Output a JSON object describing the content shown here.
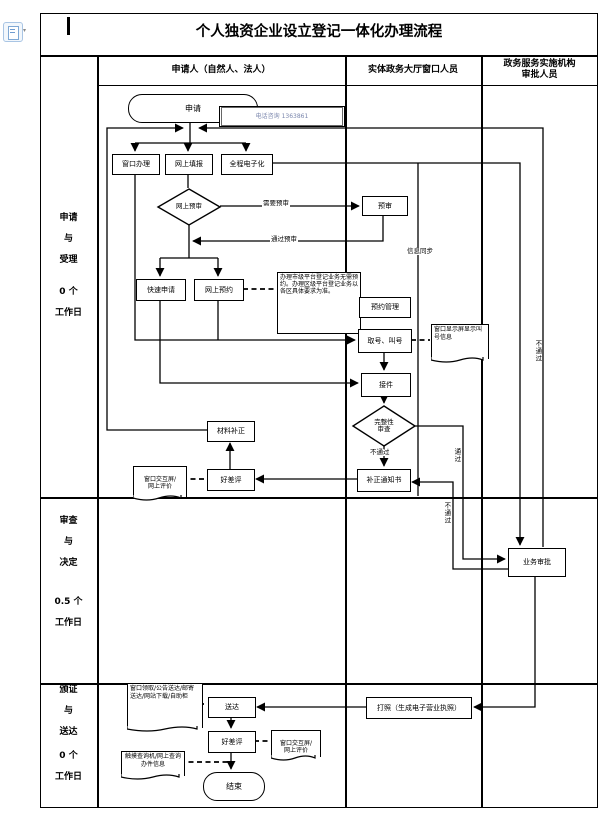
{
  "title": "个人独资企业设立登记一体化办理流程",
  "icons": {
    "top_left": "paste-options-icon",
    "top_left_caret": "dropdown-caret",
    "cursor_mark": "text-cursor-bar"
  },
  "header": {
    "col_applicant": "申请人（自然人、法人）",
    "col_window": "实体政务大厅窗口人员",
    "col_agency": "政务服务实施机构\n审批人员"
  },
  "stages": {
    "apply": {
      "name": "申请\n与\n受理",
      "duration": "0 个\n工作日"
    },
    "review": {
      "name": "审查\n与\n决定",
      "duration": "0.5 个\n工作日"
    },
    "issue": {
      "name": "颁证\n与\n送达",
      "duration": "0 个\n工作日"
    }
  },
  "nodes": {
    "start": "申请",
    "phone_note": "电话咨询 1363861",
    "window_handle": "窗口办理",
    "online_fill": "网上填报",
    "full_electronic": "全程电子化",
    "online_precheck": "网上预审",
    "precheck": "预审",
    "quick_apply": "快速申请",
    "online_booking": "网上预约",
    "booking_note": "办理市级平台登记业务无需预约。办理区级平台登记业务以各区具体要求为准。",
    "booking_mgmt": "预约管理",
    "take_number": "取号、叫号",
    "screen_note": "窗口显示屏显示叫号信息",
    "receive": "接件",
    "completeness_check": "完整性\n审查",
    "correction_notice": "补正通知书",
    "evaluation_1": "好差评",
    "eval_note_1": "窗口交互屏/\n网上评价",
    "material_correction": "材料补正",
    "approval": "业务审批",
    "print_license": "打照（生成电子营业执照）",
    "deliver": "送达",
    "deliver_note": "窗口领取/公告送达/邮寄送达/网站下载/自助柜",
    "evaluation_2": "好差评",
    "eval_note_2": "窗口交互屏/\n网上评价",
    "query_note": "触摸查询机/网上查询办件信息",
    "end": "结束"
  },
  "edge_labels": {
    "need_precheck": "需要预审",
    "pass_precheck": "通过预审",
    "info_sync": "信息同步",
    "fail_below_diamond": "不通过",
    "pass_vertical": "通过",
    "fail_vertical_mid": "不通过",
    "fail_vertical_right": "不通过"
  }
}
